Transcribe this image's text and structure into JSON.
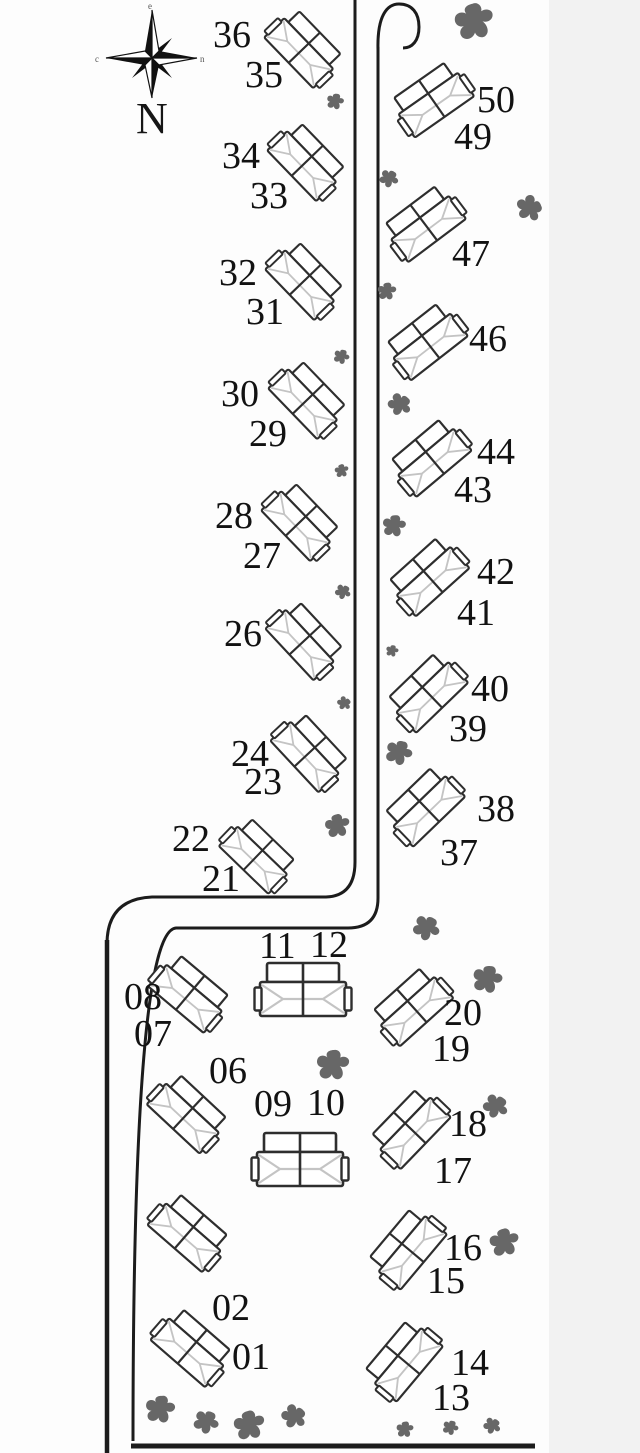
{
  "colors": {
    "background": "#fdfdfd",
    "margin_strip": "#f2f2f2",
    "line": "#1c1c1c",
    "outline": "#2e2e2e",
    "ridge": "#c4c4c4",
    "tree": "#676767",
    "label": "#121212"
  },
  "compass": {
    "label": "N",
    "tip_top": "e",
    "tip_left": "c",
    "tip_right": "n"
  },
  "buildings": [
    {
      "id": "36-35",
      "cx": 304,
      "cy": 48,
      "rot": 46,
      "s": 0.82
    },
    {
      "id": "34-33",
      "cx": 307,
      "cy": 161,
      "rot": 46,
      "s": 0.82
    },
    {
      "id": "32-31",
      "cx": 305,
      "cy": 280,
      "rot": 46,
      "s": 0.82
    },
    {
      "id": "30-29",
      "cx": 308,
      "cy": 399,
      "rot": 46,
      "s": 0.82
    },
    {
      "id": "28-27",
      "cx": 301,
      "cy": 521,
      "rot": 46,
      "s": 0.82
    },
    {
      "id": "26",
      "cx": 305,
      "cy": 640,
      "rot": 47,
      "s": 0.82
    },
    {
      "id": "24-23",
      "cx": 310,
      "cy": 752,
      "rot": 47,
      "s": 0.82
    },
    {
      "id": "22-21",
      "cx": 258,
      "cy": 855,
      "rot": 44,
      "s": 0.8
    },
    {
      "id": "50-49",
      "cx": 432,
      "cy": 99,
      "rot": -35,
      "s": 0.84
    },
    {
      "id": "47",
      "cx": 424,
      "cy": 223,
      "rot": -37,
      "s": 0.84
    },
    {
      "id": "46",
      "cx": 426,
      "cy": 341,
      "rot": -38,
      "s": 0.84
    },
    {
      "id": "44-43",
      "cx": 430,
      "cy": 457,
      "rot": -40,
      "s": 0.84
    },
    {
      "id": "42-41",
      "cx": 428,
      "cy": 576,
      "rot": -42,
      "s": 0.84
    },
    {
      "id": "40-39",
      "cx": 427,
      "cy": 692,
      "rot": -44,
      "s": 0.84
    },
    {
      "id": "38-37",
      "cx": 424,
      "cy": 806,
      "rot": -44,
      "s": 0.84
    },
    {
      "id": "20-19",
      "cx": 412,
      "cy": 1006,
      "rot": -42,
      "s": 0.84
    },
    {
      "id": "18-17",
      "cx": 410,
      "cy": 1128,
      "rot": -46,
      "s": 0.84
    },
    {
      "id": "16-15",
      "cx": 407,
      "cy": 1248,
      "rot": -50,
      "s": 0.84
    },
    {
      "id": "14-13",
      "cx": 403,
      "cy": 1360,
      "rot": -50,
      "s": 0.84
    },
    {
      "id": "08-07",
      "cx": 190,
      "cy": 993,
      "rot": 40,
      "s": 0.84
    },
    {
      "id": "06",
      "cx": 188,
      "cy": 1113,
      "rot": 43,
      "s": 0.84
    },
    {
      "id": "unlabeled",
      "cx": 189,
      "cy": 1232,
      "rot": 41,
      "s": 0.84
    },
    {
      "id": "02-01",
      "cx": 192,
      "cy": 1347,
      "rot": 41,
      "s": 0.84
    },
    {
      "id": "11-12",
      "cx": 303,
      "cy": 990,
      "rot": 0,
      "s": 1.0
    },
    {
      "id": "09-10",
      "cx": 300,
      "cy": 1160,
      "rot": 0,
      "s": 1.0
    }
  ],
  "unit_labels": [
    {
      "text": "36",
      "x": 213,
      "y": 47
    },
    {
      "text": "35",
      "x": 245,
      "y": 87
    },
    {
      "text": "34",
      "x": 222,
      "y": 168
    },
    {
      "text": "33",
      "x": 250,
      "y": 208
    },
    {
      "text": "32",
      "x": 219,
      "y": 285
    },
    {
      "text": "31",
      "x": 246,
      "y": 324
    },
    {
      "text": "30",
      "x": 221,
      "y": 406
    },
    {
      "text": "29",
      "x": 249,
      "y": 446
    },
    {
      "text": "28",
      "x": 215,
      "y": 528
    },
    {
      "text": "27",
      "x": 243,
      "y": 568
    },
    {
      "text": "26",
      "x": 224,
      "y": 646
    },
    {
      "text": "24",
      "x": 231,
      "y": 766
    },
    {
      "text": "23",
      "x": 244,
      "y": 794
    },
    {
      "text": "22",
      "x": 172,
      "y": 851
    },
    {
      "text": "21",
      "x": 202,
      "y": 891
    },
    {
      "text": "50",
      "x": 477,
      "y": 112
    },
    {
      "text": "49",
      "x": 454,
      "y": 149
    },
    {
      "text": "47",
      "x": 452,
      "y": 266
    },
    {
      "text": "46",
      "x": 469,
      "y": 351
    },
    {
      "text": "44",
      "x": 477,
      "y": 464
    },
    {
      "text": "43",
      "x": 454,
      "y": 502
    },
    {
      "text": "42",
      "x": 477,
      "y": 584
    },
    {
      "text": "41",
      "x": 457,
      "y": 625
    },
    {
      "text": "40",
      "x": 471,
      "y": 701
    },
    {
      "text": "39",
      "x": 449,
      "y": 741
    },
    {
      "text": "38",
      "x": 477,
      "y": 821
    },
    {
      "text": "37",
      "x": 440,
      "y": 865
    },
    {
      "text": "20",
      "x": 444,
      "y": 1025
    },
    {
      "text": "19",
      "x": 432,
      "y": 1061
    },
    {
      "text": "18",
      "x": 449,
      "y": 1136
    },
    {
      "text": "17",
      "x": 434,
      "y": 1183
    },
    {
      "text": "16",
      "x": 444,
      "y": 1260
    },
    {
      "text": "15",
      "x": 427,
      "y": 1293
    },
    {
      "text": "14",
      "x": 451,
      "y": 1375
    },
    {
      "text": "13",
      "x": 432,
      "y": 1410
    },
    {
      "text": "11",
      "x": 259,
      "y": 958
    },
    {
      "text": "12",
      "x": 310,
      "y": 957
    },
    {
      "text": "09",
      "x": 254,
      "y": 1116
    },
    {
      "text": "10",
      "x": 307,
      "y": 1115
    },
    {
      "text": "08",
      "x": 124,
      "y": 1009
    },
    {
      "text": "07",
      "x": 134,
      "y": 1046
    },
    {
      "text": "06",
      "x": 209,
      "y": 1083
    },
    {
      "text": "02",
      "x": 212,
      "y": 1320
    },
    {
      "text": "01",
      "x": 232,
      "y": 1369
    }
  ],
  "trees": [
    {
      "x": 475,
      "y": 25,
      "s": 1.25,
      "r": 0
    },
    {
      "x": 335,
      "y": 103,
      "s": 0.55,
      "r": 20
    },
    {
      "x": 388,
      "y": 180,
      "s": 0.6,
      "r": 45
    },
    {
      "x": 527,
      "y": 209,
      "s": 0.85,
      "r": 85
    },
    {
      "x": 387,
      "y": 293,
      "s": 0.6,
      "r": 10
    },
    {
      "x": 341,
      "y": 358,
      "s": 0.5,
      "r": 30
    },
    {
      "x": 398,
      "y": 406,
      "s": 0.75,
      "r": 60
    },
    {
      "x": 342,
      "y": 472,
      "s": 0.45,
      "r": 0
    },
    {
      "x": 394,
      "y": 528,
      "s": 0.75,
      "r": 15
    },
    {
      "x": 342,
      "y": 593,
      "s": 0.5,
      "r": 50
    },
    {
      "x": 392,
      "y": 652,
      "s": 0.4,
      "r": 20
    },
    {
      "x": 343,
      "y": 704,
      "s": 0.45,
      "r": 70
    },
    {
      "x": 398,
      "y": 755,
      "s": 0.85,
      "r": 30
    },
    {
      "x": 338,
      "y": 828,
      "s": 0.8,
      "r": 0
    },
    {
      "x": 425,
      "y": 930,
      "s": 0.85,
      "r": 45
    },
    {
      "x": 487,
      "y": 982,
      "s": 0.95,
      "r": 20
    },
    {
      "x": 333,
      "y": 1068,
      "s": 1.05,
      "r": 10
    },
    {
      "x": 494,
      "y": 1108,
      "s": 0.8,
      "r": 55
    },
    {
      "x": 505,
      "y": 1245,
      "s": 0.95,
      "r": 0
    },
    {
      "x": 160,
      "y": 1412,
      "s": 0.95,
      "r": 15
    },
    {
      "x": 205,
      "y": 1424,
      "s": 0.8,
      "r": 40
    },
    {
      "x": 250,
      "y": 1428,
      "s": 1.0,
      "r": 0
    },
    {
      "x": 292,
      "y": 1418,
      "s": 0.8,
      "r": 65
    },
    {
      "x": 405,
      "y": 1431,
      "s": 0.55,
      "r": 10
    },
    {
      "x": 450,
      "y": 1429,
      "s": 0.5,
      "r": 30
    },
    {
      "x": 491,
      "y": 1427,
      "s": 0.55,
      "r": 55
    }
  ]
}
